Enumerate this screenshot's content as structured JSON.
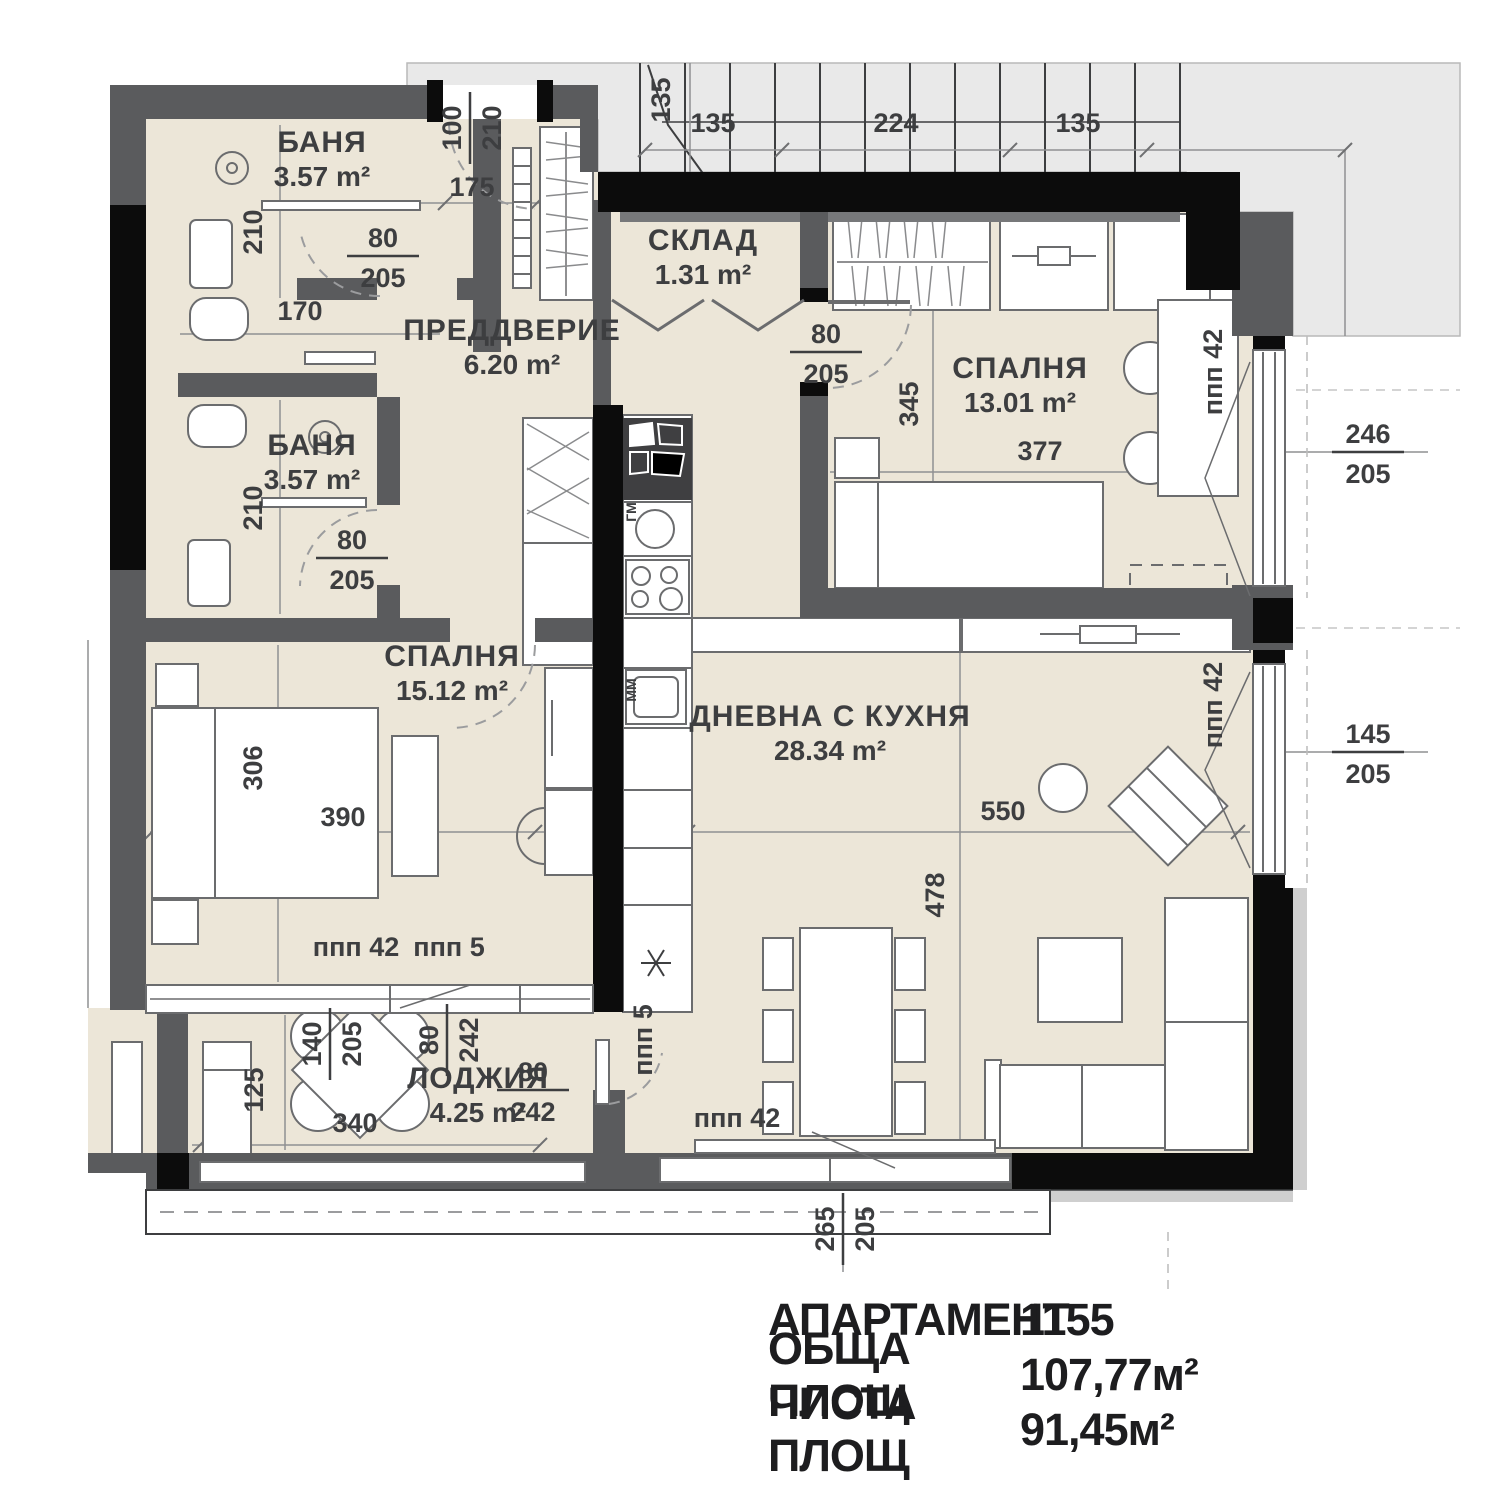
{
  "plan_title": "Апартамент 1155 - архитектурен план",
  "colors": {
    "room_fill": "#ece6d8",
    "wall_gray": "#5a5b5d",
    "structure_black": "#0c0c0c",
    "exterior_gray": "#e9e9e9",
    "furniture_line": "#6b6c6e",
    "dim_text": "#3d3e40"
  },
  "rooms": [
    {
      "id": "banya-1",
      "name": "БАНЯ",
      "area": "3.57 m²",
      "x": 322,
      "y": 152
    },
    {
      "id": "banya-2",
      "name": "БАНЯ",
      "area": "3.57 m²",
      "x": 312,
      "y": 455
    },
    {
      "id": "preddverie",
      "name": "ПРЕДДВЕРИЕ",
      "area": "6.20 m²",
      "x": 512,
      "y": 340
    },
    {
      "id": "sklad",
      "name": "СКЛАД",
      "area": "1.31 m²",
      "x": 703,
      "y": 250
    },
    {
      "id": "spalnya-13",
      "name": "СПАЛНЯ",
      "area": "13.01 m²",
      "x": 1020,
      "y": 378
    },
    {
      "id": "spalnya-15",
      "name": "СПАЛНЯ",
      "area": "15.12 m²",
      "x": 452,
      "y": 666
    },
    {
      "id": "dnevna",
      "name": "ДНЕВНА С КУХНЯ",
      "area": "28.34 m²",
      "x": 830,
      "y": 726
    },
    {
      "id": "lodzhia",
      "name": "ЛОДЖИЯ",
      "area": "4.25 m²",
      "x": 478,
      "y": 1088
    }
  ],
  "dim_labels": [
    {
      "t": "135",
      "x": 713,
      "y": 132
    },
    {
      "t": "224",
      "x": 896,
      "y": 132
    },
    {
      "t": "135",
      "x": 1078,
      "y": 132
    },
    {
      "t": "135",
      "x": 670,
      "y": 100,
      "r": -90
    },
    {
      "t": "175",
      "x": 472,
      "y": 196
    },
    {
      "t": "170",
      "x": 300,
      "y": 320
    },
    {
      "t": "210",
      "x": 262,
      "y": 232,
      "r": -90
    },
    {
      "t": "210",
      "x": 262,
      "y": 508,
      "r": -90
    },
    {
      "t": "345",
      "x": 918,
      "y": 404,
      "r": -90
    },
    {
      "t": "377",
      "x": 1040,
      "y": 460
    },
    {
      "t": "306",
      "x": 262,
      "y": 768,
      "r": -90
    },
    {
      "t": "390",
      "x": 343,
      "y": 826
    },
    {
      "t": "550",
      "x": 1003,
      "y": 820
    },
    {
      "t": "478",
      "x": 944,
      "y": 895,
      "r": -90
    },
    {
      "t": "340",
      "x": 355,
      "y": 1132
    },
    {
      "t": "125",
      "x": 263,
      "y": 1090,
      "r": -90
    },
    {
      "t": "ппп 42",
      "x": 356,
      "y": 956
    },
    {
      "t": "ппп 5",
      "x": 449,
      "y": 956
    },
    {
      "t": "ппп 42",
      "x": 737,
      "y": 1127
    },
    {
      "t": "ппп 42",
      "x": 1222,
      "y": 372,
      "r": -90
    },
    {
      "t": "ппп 42",
      "x": 1222,
      "y": 705,
      "r": -90
    },
    {
      "t": "ппп 5",
      "x": 652,
      "y": 1040,
      "r": -90
    },
    {
      "t": "ГМ",
      "x": 636,
      "y": 512,
      "r": -90,
      "s": 14
    },
    {
      "t": "ММ",
      "x": 636,
      "y": 690,
      "r": -90,
      "s": 14
    }
  ],
  "fraction_labels": [
    {
      "top": "80",
      "bottom": "205",
      "x": 383,
      "y": 256
    },
    {
      "top": "80",
      "bottom": "205",
      "x": 352,
      "y": 558
    },
    {
      "top": "80",
      "bottom": "205",
      "x": 826,
      "y": 352
    },
    {
      "top": "100",
      "bottom": "210",
      "x": 470,
      "y": 128,
      "r": -90
    },
    {
      "top": "246",
      "bottom": "205",
      "x": 1368,
      "y": 452
    },
    {
      "top": "145",
      "bottom": "205",
      "x": 1368,
      "y": 752
    },
    {
      "top": "140",
      "bottom": "205",
      "x": 330,
      "y": 1044,
      "r": -90
    },
    {
      "top": "80",
      "bottom": "242",
      "x": 447,
      "y": 1040,
      "r": -90
    },
    {
      "top": "80",
      "bottom": "242",
      "x": 533,
      "y": 1090
    },
    {
      "top": "265",
      "bottom": "205",
      "x": 843,
      "y": 1229,
      "r": -90
    }
  ],
  "summary": {
    "rows": [
      {
        "label": "АПАРТАМЕНТ",
        "value": "1155"
      },
      {
        "label": "ОБЩА ПЛОЩ",
        "value": "107,77м²"
      },
      {
        "label": "ЧИСТА ПЛОЩ",
        "value": "91,45м²"
      }
    ]
  }
}
